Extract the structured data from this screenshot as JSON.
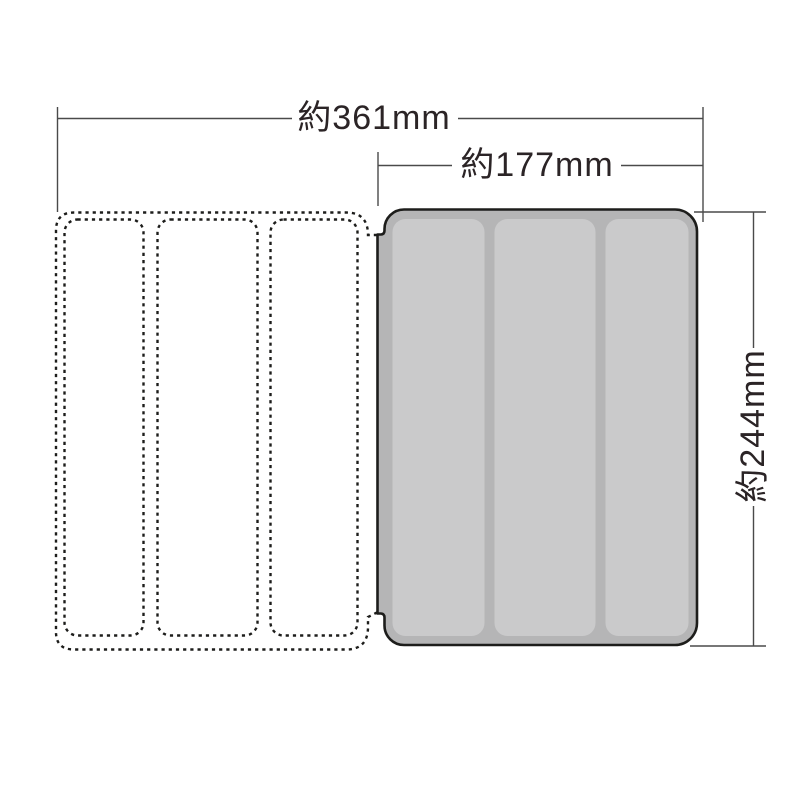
{
  "diagram": {
    "type": "product-dimension-drawing",
    "subject": "tri-fold tablet case: opened stitched cover (dotted outline) and case back shell (gray)",
    "dimensions": {
      "total_width": {
        "label": "約361mm"
      },
      "case_width": {
        "label": "約177mm"
      },
      "case_height": {
        "label": "約244mm"
      }
    },
    "colors": {
      "background": "#ffffff",
      "case_fill": "#b5b5b6",
      "panel_fill": "#cacacb",
      "outline": "#1d1d1b",
      "dimension_line": "#4a4a4a",
      "text": "#2b2426"
    }
  }
}
